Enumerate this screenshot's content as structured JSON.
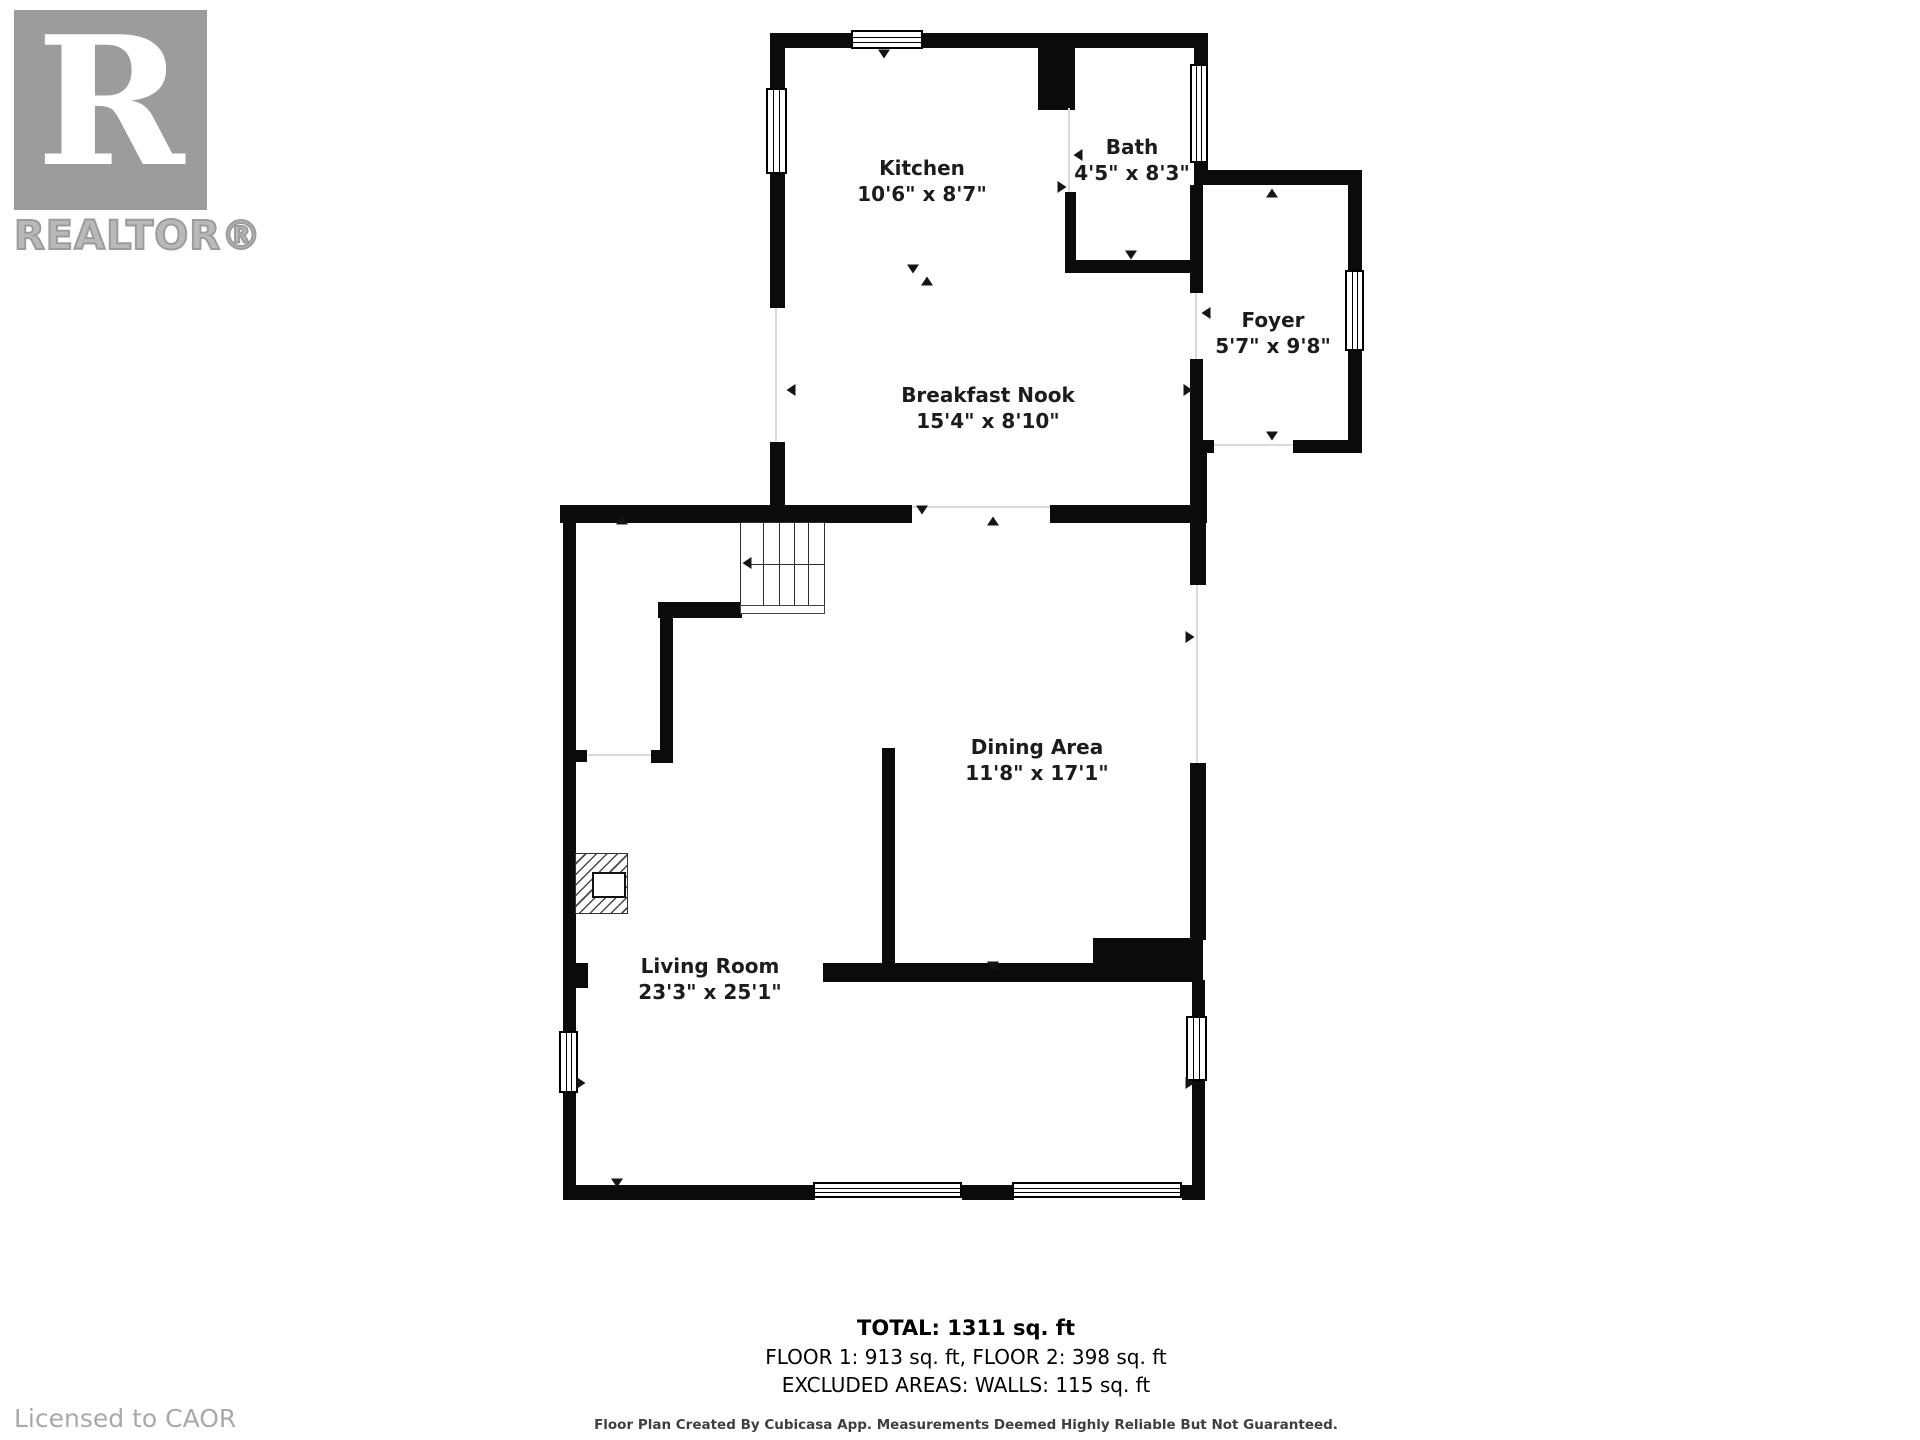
{
  "branding": {
    "logo_letter": "R",
    "logo_text": "REALTOR®",
    "license_text": "Licensed to CAOR"
  },
  "rooms": {
    "kitchen": {
      "name": "Kitchen",
      "dims": "10'6\" x 8'7\""
    },
    "bath": {
      "name": "Bath",
      "dims": "4'5\" x 8'3\""
    },
    "foyer": {
      "name": "Foyer",
      "dims": "5'7\" x 9'8\""
    },
    "breakfast_nook": {
      "name": "Breakfast Nook",
      "dims": "15'4\" x 8'10\""
    },
    "dining_area": {
      "name": "Dining Area",
      "dims": "11'8\" x 17'1\""
    },
    "living_room": {
      "name": "Living Room",
      "dims": "23'3\" x 25'1\""
    }
  },
  "summary": {
    "total": "TOTAL: 1311 sq. ft",
    "floors": "FLOOR 1: 913 sq. ft, FLOOR 2: 398 sq. ft",
    "excluded": "EXCLUDED AREAS: WALLS: 115 sq. ft",
    "disclaimer": "Floor Plan Created By Cubicasa App. Measurements Deemed Highly Reliable But Not Guaranteed."
  },
  "colors": {
    "wall": "#0b0b0b",
    "txt": "#1c1c1c",
    "logo": "#9c9c9c",
    "lic": "#a9a9a9",
    "disc": "#3f3f3f",
    "open": "#d9d9d9"
  }
}
